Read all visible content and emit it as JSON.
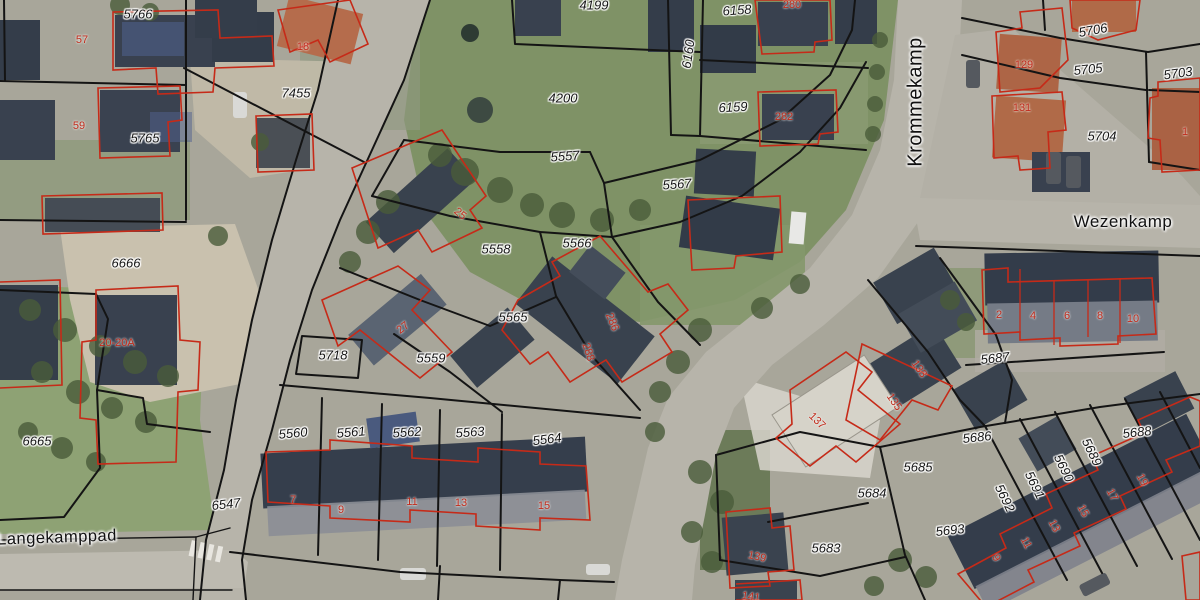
{
  "map": {
    "colors": {
      "parcel_boundary": "#141414",
      "building_outline": "#c62a18",
      "parcel_label_color": "#151515",
      "house_number_color": "#c02b1b",
      "road_fill": "#b7b4aa",
      "grass_fill": "#7f9266"
    },
    "street_labels": [
      {
        "text": "Krommekamp",
        "x": 916,
        "y": 102,
        "rot": -90,
        "size": 20
      },
      {
        "text": "Wezenkamp",
        "x": 1123,
        "y": 222,
        "rot": 0,
        "size": 17
      },
      {
        "text": "Langekamppad",
        "x": 57,
        "y": 538,
        "rot": -2,
        "size": 16.5
      }
    ],
    "parcel_labels": [
      {
        "text": "5766",
        "x": 138,
        "y": 14,
        "rot": 0
      },
      {
        "text": "5765",
        "x": 145,
        "y": 138,
        "rot": 0
      },
      {
        "text": "7455",
        "x": 296,
        "y": 93,
        "rot": 0
      },
      {
        "text": "6666",
        "x": 126,
        "y": 263,
        "rot": 0
      },
      {
        "text": "6665",
        "x": 37,
        "y": 441,
        "rot": 0
      },
      {
        "text": "5718",
        "x": 333,
        "y": 355,
        "rot": 0
      },
      {
        "text": "6547",
        "x": 226,
        "y": 504,
        "rot": -6
      },
      {
        "text": "4199",
        "x": 594,
        "y": 5,
        "rot": 0
      },
      {
        "text": "4200",
        "x": 563,
        "y": 98,
        "rot": 0
      },
      {
        "text": "5557",
        "x": 565,
        "y": 156,
        "rot": -4
      },
      {
        "text": "6160",
        "x": 688,
        "y": 54,
        "rot": -82
      },
      {
        "text": "6158",
        "x": 737,
        "y": 10,
        "rot": -4
      },
      {
        "text": "6159",
        "x": 733,
        "y": 107,
        "rot": -3
      },
      {
        "text": "5567",
        "x": 677,
        "y": 184,
        "rot": -4
      },
      {
        "text": "5558",
        "x": 496,
        "y": 249,
        "rot": 0
      },
      {
        "text": "5566",
        "x": 577,
        "y": 243,
        "rot": 0
      },
      {
        "text": "5565",
        "x": 513,
        "y": 317,
        "rot": 0
      },
      {
        "text": "5559",
        "x": 431,
        "y": 358,
        "rot": 0
      },
      {
        "text": "5706",
        "x": 1093,
        "y": 30,
        "rot": -10
      },
      {
        "text": "5705",
        "x": 1088,
        "y": 69,
        "rot": -6
      },
      {
        "text": "5703",
        "x": 1178,
        "y": 73,
        "rot": -8
      },
      {
        "text": "5704",
        "x": 1102,
        "y": 136,
        "rot": 0
      },
      {
        "text": "5687",
        "x": 995,
        "y": 358,
        "rot": -6
      },
      {
        "text": "5686",
        "x": 977,
        "y": 437,
        "rot": -6
      },
      {
        "text": "5685",
        "x": 918,
        "y": 467,
        "rot": 0
      },
      {
        "text": "5684",
        "x": 872,
        "y": 493,
        "rot": 0
      },
      {
        "text": "5693",
        "x": 950,
        "y": 530,
        "rot": -6
      },
      {
        "text": "5683",
        "x": 826,
        "y": 548,
        "rot": 0
      },
      {
        "text": "5688",
        "x": 1137,
        "y": 432,
        "rot": -6
      },
      {
        "text": "5689",
        "x": 1092,
        "y": 452,
        "rot": 64
      },
      {
        "text": "5690",
        "x": 1064,
        "y": 468,
        "rot": 64
      },
      {
        "text": "5691",
        "x": 1035,
        "y": 485,
        "rot": 64
      },
      {
        "text": "5692",
        "x": 1005,
        "y": 498,
        "rot": 64
      },
      {
        "text": "5560",
        "x": 293,
        "y": 433,
        "rot": -5
      },
      {
        "text": "5561",
        "x": 351,
        "y": 432,
        "rot": -5
      },
      {
        "text": "5562",
        "x": 407,
        "y": 432,
        "rot": -4
      },
      {
        "text": "5563",
        "x": 470,
        "y": 432,
        "rot": -4
      },
      {
        "text": "5564",
        "x": 547,
        "y": 439,
        "rot": -7
      }
    ],
    "house_labels": [
      {
        "text": "57",
        "x": 82,
        "y": 40,
        "rot": 0
      },
      {
        "text": "59",
        "x": 79,
        "y": 126,
        "rot": 0
      },
      {
        "text": "18",
        "x": 303,
        "y": 47,
        "rot": 0
      },
      {
        "text": "280",
        "x": 792,
        "y": 5,
        "rot": 0
      },
      {
        "text": "282",
        "x": 784,
        "y": 117,
        "rot": 0
      },
      {
        "text": "129",
        "x": 1024,
        "y": 65,
        "rot": 0
      },
      {
        "text": "131",
        "x": 1022,
        "y": 108,
        "rot": 0
      },
      {
        "text": "1",
        "x": 1185,
        "y": 132,
        "rot": 0
      },
      {
        "text": "20-20A",
        "x": 117,
        "y": 343,
        "rot": 0
      },
      {
        "text": "25",
        "x": 460,
        "y": 214,
        "rot": 40
      },
      {
        "text": "27",
        "x": 403,
        "y": 328,
        "rot": -38
      },
      {
        "text": "286",
        "x": 612,
        "y": 322,
        "rot": 68
      },
      {
        "text": "288",
        "x": 588,
        "y": 352,
        "rot": 72
      },
      {
        "text": "7",
        "x": 293,
        "y": 500,
        "rot": 0
      },
      {
        "text": "9",
        "x": 341,
        "y": 510,
        "rot": 0
      },
      {
        "text": "11",
        "x": 412,
        "y": 502,
        "rot": 0
      },
      {
        "text": "13",
        "x": 461,
        "y": 503,
        "rot": 0
      },
      {
        "text": "15",
        "x": 544,
        "y": 506,
        "rot": 0
      },
      {
        "text": "2",
        "x": 999,
        "y": 315,
        "rot": 0
      },
      {
        "text": "4",
        "x": 1033,
        "y": 316,
        "rot": 0
      },
      {
        "text": "6",
        "x": 1067,
        "y": 316,
        "rot": 0
      },
      {
        "text": "8",
        "x": 1100,
        "y": 316,
        "rot": 0
      },
      {
        "text": "10",
        "x": 1133,
        "y": 319,
        "rot": 0
      },
      {
        "text": "133",
        "x": 919,
        "y": 369,
        "rot": 55
      },
      {
        "text": "135",
        "x": 894,
        "y": 402,
        "rot": 55
      },
      {
        "text": "137",
        "x": 817,
        "y": 421,
        "rot": 45
      },
      {
        "text": "139",
        "x": 757,
        "y": 557,
        "rot": 12
      },
      {
        "text": "141",
        "x": 751,
        "y": 597,
        "rot": 8
      },
      {
        "text": "9",
        "x": 996,
        "y": 558,
        "rot": 62
      },
      {
        "text": "11",
        "x": 1026,
        "y": 543,
        "rot": 62
      },
      {
        "text": "13",
        "x": 1054,
        "y": 526,
        "rot": 62
      },
      {
        "text": "15",
        "x": 1083,
        "y": 511,
        "rot": 62
      },
      {
        "text": "17",
        "x": 1112,
        "y": 495,
        "rot": 62
      },
      {
        "text": "19",
        "x": 1142,
        "y": 480,
        "rot": 62
      }
    ]
  }
}
